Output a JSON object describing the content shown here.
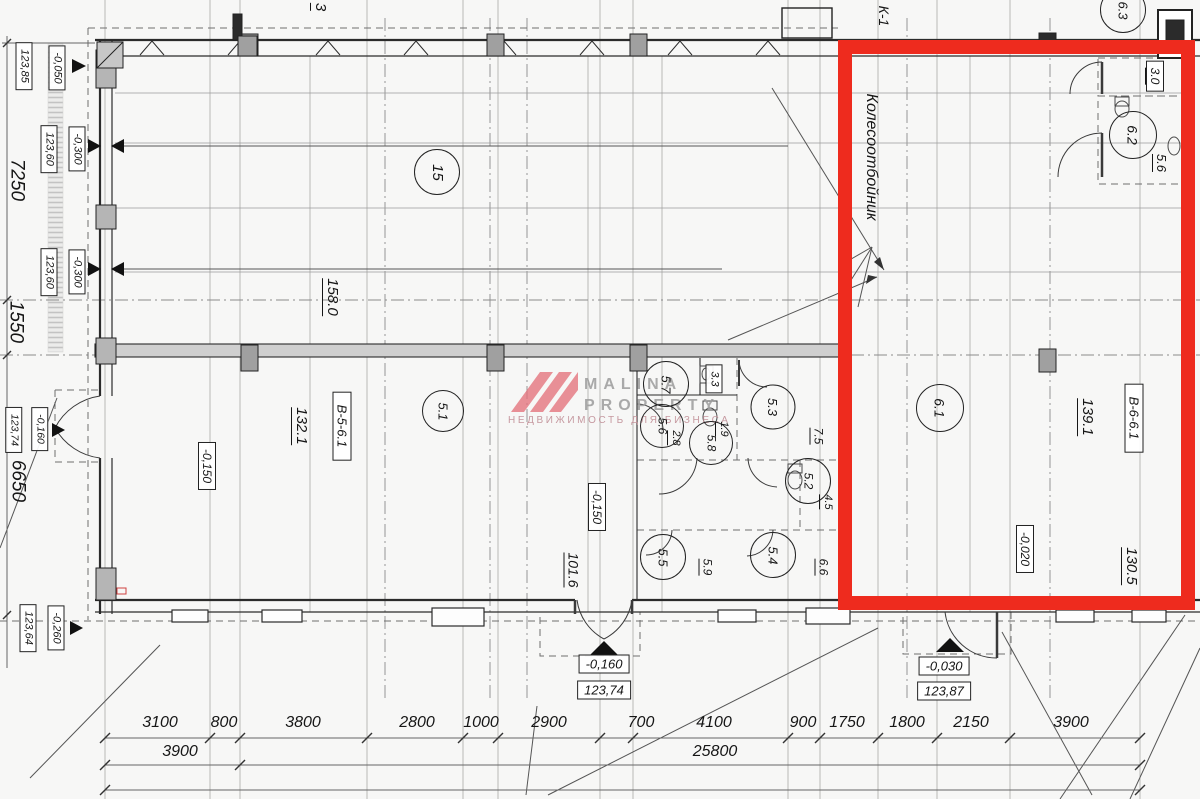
{
  "highlight_color": "#ee2b1e",
  "watermark": {
    "brand_line1": "MALINA",
    "brand_line2": "PROPERTY",
    "tagline": "НЕДВИЖИМОСТЬ ДЛЯ БИЗНЕСА",
    "accent": "#e4737c"
  },
  "labels": {
    "room15": "15",
    "room51": "5.1",
    "room57": "5.7",
    "room56": "5.6",
    "room58": "5.8",
    "room53": "5.3",
    "room52": "5.2",
    "room55": "5.5",
    "room54": "5.4",
    "room61": "6.1",
    "room62": "6.2",
    "room63": "6.3",
    "area158": "158.0",
    "area1321": "132.1",
    "area1016": "101.6",
    "area33": "3.3",
    "area28": "2.8",
    "area19": "1.9",
    "area75": "7.5",
    "area45": "4.5",
    "area59": "5.9",
    "area66": "6.6",
    "area1391": "139.1",
    "area1305": "130.5",
    "area30": "3.0",
    "area56": "5.6",
    "unit_b56": "В-5-6.1",
    "unit_b66": "В-6-6.1",
    "note_wheel_stop": "Колесоотбойник",
    "axis_k1": "К-1",
    "axis_3": "3"
  },
  "floor_marks": {
    "m150a": "-0,150",
    "m150b": "-0,150",
    "m020": "-0,020"
  },
  "side_elevations": [
    {
      "elev": "123,85",
      "offset": "-0,050"
    },
    {
      "elev": "123,60",
      "offset": "-0,300"
    },
    {
      "elev": "123,60",
      "offset": "-0,300"
    },
    {
      "elev": "123,74",
      "offset": "-0,160"
    },
    {
      "elev": "123,64",
      "offset": "-0,260"
    }
  ],
  "side_dims": {
    "v7250": "7250",
    "v1550": "1550",
    "v6650": "6650"
  },
  "entry_marks": [
    {
      "offset": "-0,160",
      "elev": "123,74"
    },
    {
      "offset": "-0,030",
      "elev": "123,87"
    }
  ],
  "dims_row1": [
    "3100",
    "800",
    "3800",
    "2800",
    "1000",
    "2900",
    "700",
    "4100",
    "900",
    "1750",
    "1800",
    "2150",
    "3900"
  ],
  "dims_row2": [
    "3900",
    "25800"
  ]
}
